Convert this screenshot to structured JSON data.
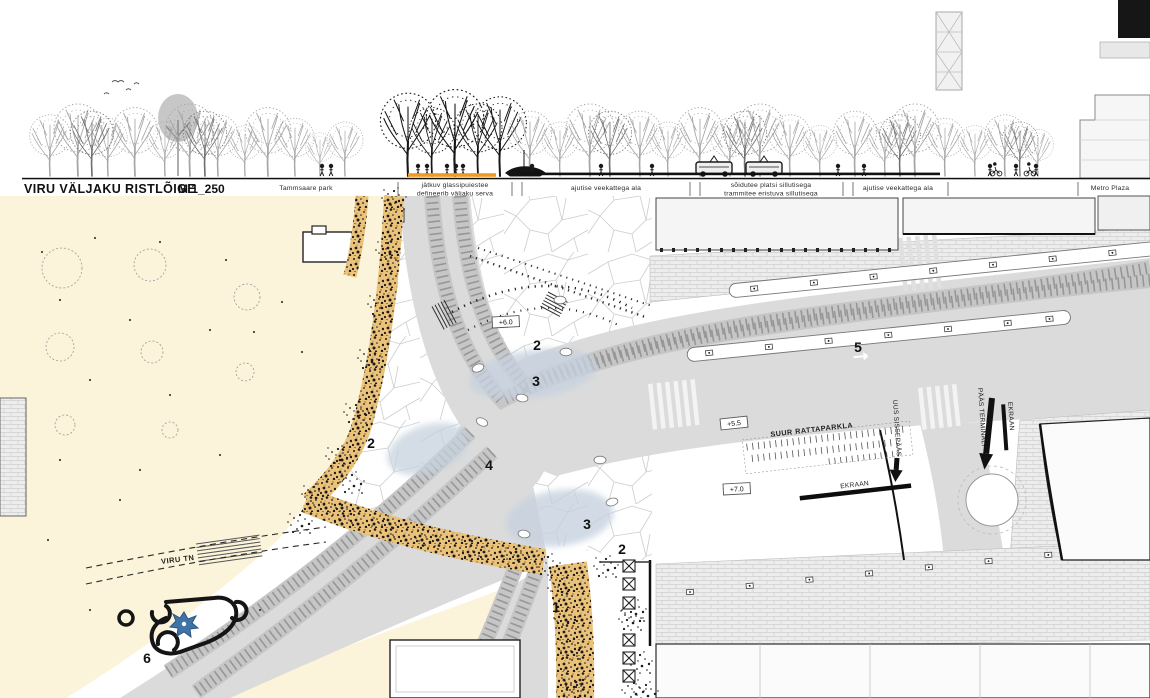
{
  "section": {
    "title": "VIRU VÄLJAKU RISTLÕIGE",
    "scale": "M 1_250",
    "segments": [
      {
        "lines": [
          "Tammsaare park",
          ""
        ]
      },
      {
        "lines": [
          "jätkuv glassipuiestee",
          "defineerib väljaku serva"
        ]
      },
      {
        "lines": [
          "ajutise veekattega ala",
          ""
        ]
      },
      {
        "lines": [
          "sõidutee platsi sillutisega",
          "trammitee eristuva sillutisega"
        ]
      },
      {
        "lines": [
          "ajutise veekattega ala",
          ""
        ]
      },
      {
        "lines": [
          "Metro Plaza",
          ""
        ]
      }
    ]
  },
  "plan": {
    "street_label": "VIRU TN",
    "bike_parking_label": "SUUR RATTAPARKLA",
    "screen_label": "EKRAAN",
    "screen_label_2": "EKRAAN",
    "entrance_label": "UUS SISSEPÄÄS",
    "terminal_label": "PÄÄS TERMINALI",
    "levels": {
      "plaza": "+6.0",
      "bike": "+5.5",
      "screen": "+7.0"
    },
    "area_markers": [
      "2",
      "3",
      "2",
      "4",
      "3",
      "2",
      "1",
      "5",
      "6"
    ]
  },
  "colors": {
    "cream": "#fbf4da",
    "road_grey": "#dbdbdb",
    "tram_tie": "#949494",
    "strip_orange": "#eac27a",
    "highlight_orange": "#f2991f",
    "water_blue": "#c5d1de",
    "ink": "#111111"
  }
}
